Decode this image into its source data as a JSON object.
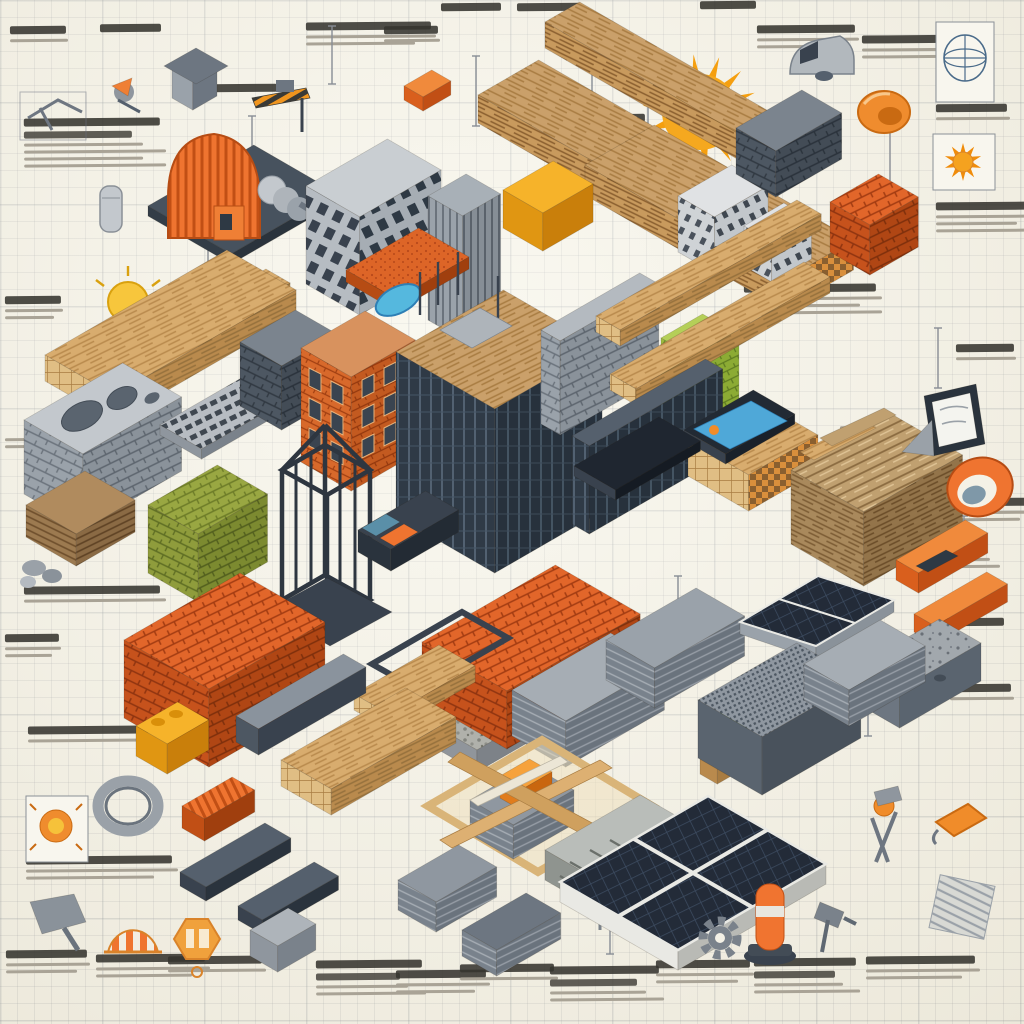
{
  "scene": {
    "description": "Isometric infographic collage of construction materials, building models and tools, hand-sketched on cream graph paper with annotation notes",
    "annotation_text_style": "illegible pseudo-handwriting scribbles",
    "annotation_count": 39
  },
  "palette": {
    "background": "#f4f1e6",
    "grid_line": "#aeb2bc",
    "ink": "#35342f",
    "ink_light": "#a9a396",
    "sketch_gray": "#6e7681",
    "orange": "#ef7430",
    "orange_deep": "#c14f15",
    "brick": "#e2662a",
    "yellow": "#f6b32a",
    "olive": "#8f9c3c",
    "lime": "#9cbb3f",
    "slate": "#39424e",
    "concrete": "#b8bcc1",
    "wood": "#d8ac6e",
    "wood_dark": "#a87c42",
    "solar_panel": "#232b38",
    "screen_blue": "#4fa8d8",
    "leaf_green": "#7cb845",
    "sun_orange": "#f59f0f"
  },
  "items": {
    "sun": "bright orange sun",
    "blueprint-globe-sketch": "boxed blueprint globe sketch",
    "helmet-sketch": "orange safety helmet sketch",
    "sun-sketch-box": "boxed orange sun sketch",
    "van-sketch": "delivery van sketch",
    "outhouse-sketch": "small shed model",
    "planer-sketch": "hand planer sketch",
    "water-heater-sketch": "cylinder tank sketch",
    "rock-samples-sketch": "aggregate rock samples",
    "light-bulb": "yellow light bulb",
    "timber-beam": "heavy timber beam",
    "lumber-bundle-a": "bundle of planed lumber",
    "lumber-bundle-b": "bundle of planed lumber",
    "stick-bundle": "bundle of cut timber sticks",
    "white-building-a": "white building model",
    "white-building-b": "white building model",
    "concrete-stack-topright": "dark concrete block stack",
    "brick-cube": "cube of orange bricks",
    "base-plate": "dark steel base plate",
    "quonset-roof-unit": "corrugated orange arch roof unit",
    "concrete-frame-building": "concrete frame building model",
    "skyscraper-model": "high-rise tower model",
    "hazard-crane-arm": "striped crane arm",
    "orange-capsule": "orange capsule block",
    "yellow-block": "yellow masonry block",
    "orange-tile-pool": "orange roof tile with pool cutout",
    "beam-pair": "pair of wooden beams",
    "concrete-pyramid": "concrete pyramid cap",
    "log-beams": "stack of wooden beams",
    "log-pile": "pile of round logs",
    "cinder-block-large": "large hollow concrete block",
    "keyboard": "computer keyboard",
    "cinder-stack-dark": "dark cinder block stack",
    "brick-building": "orange brick apartment building",
    "glass-building": "glass building under construction",
    "gray-brick-wall": "gray brick wall section",
    "cross-beam-a": "wooden cross beam",
    "insulation-green": "green insulation roll pack",
    "cross-beam-b": "wooden cross beam",
    "glass-facade": "dark glazed curtain wall",
    "tablet-flat": "tablet with blue screen",
    "lumber-rough": "stack of rough reclaimed lumber",
    "e-reader": "e-reader on stand",
    "orange-ring": "orange ring tool",
    "display-panel": "flat dark display panel",
    "olive-bale": "olive green brick bale",
    "steel-cage": "steel frame cage",
    "ramp-wedge": "wedge ramp with inlays",
    "wood-slab-layered": "layered wood slab",
    "level-tool": "orange spirit level",
    "orange-beam-br": "orange structural beam",
    "speckle-block": "speckled concrete block",
    "gravel-base": "gravel and mesh base pad",
    "brick-slab": "slab of red clay bricks",
    "frame-tray": "dark frame tray",
    "planks-small": "small wooden planks",
    "shingle-stack-a": "stack of gray roofing sheets",
    "shingle-stack-b": "stack of gray roofing sheets",
    "solar-wedge": "tilted solar panel",
    "green-globe": "green globe marker",
    "pedestal": "wooden pedestal",
    "block-stack-big": "textured concrete block stack",
    "shingle-stack-c": "stack of gray roofing sheets",
    "brick-pallet": "pallet of orange clay bricks",
    "yellow-interlock": "yellow interlocking blocks",
    "i-beam": "steel I-beam",
    "plank-bundle": "bundle of wooden planks",
    "orange-ridge-beam": "orange corrugated beam",
    "plank-crate": "crate of crossed planks and shingles",
    "medallion-sign": "orange medallion sign",
    "rebar-tray": "tray with diagonal rebar",
    "solar-array": "flat solar panel array",
    "sun-splash-sketch": "boxed sun splash sketch",
    "coil-ring": "coiled gray ring",
    "dustpan-sketch": "dustpan sketch",
    "awning-dome": "orange striped awning dome",
    "hex-badge": "orange hexagonal badge",
    "track-a": "dark channel track",
    "track-b": "dark channel track",
    "gray-box": "gray utility box",
    "shingle-bl-a": "shingle stack",
    "shingle-bl-b": "shingle stack",
    "gear": "gray gear",
    "safety-bollard": "orange safety bollard",
    "pliers-sketch": "pliers tool sketch",
    "orange-sander": "orange sander tool",
    "drill-sketch": "power drill sketch",
    "ribbed-panel-sketch": "ribbed panel sketch",
    "clamp-tool-sketch": "clamp tool sketch"
  }
}
